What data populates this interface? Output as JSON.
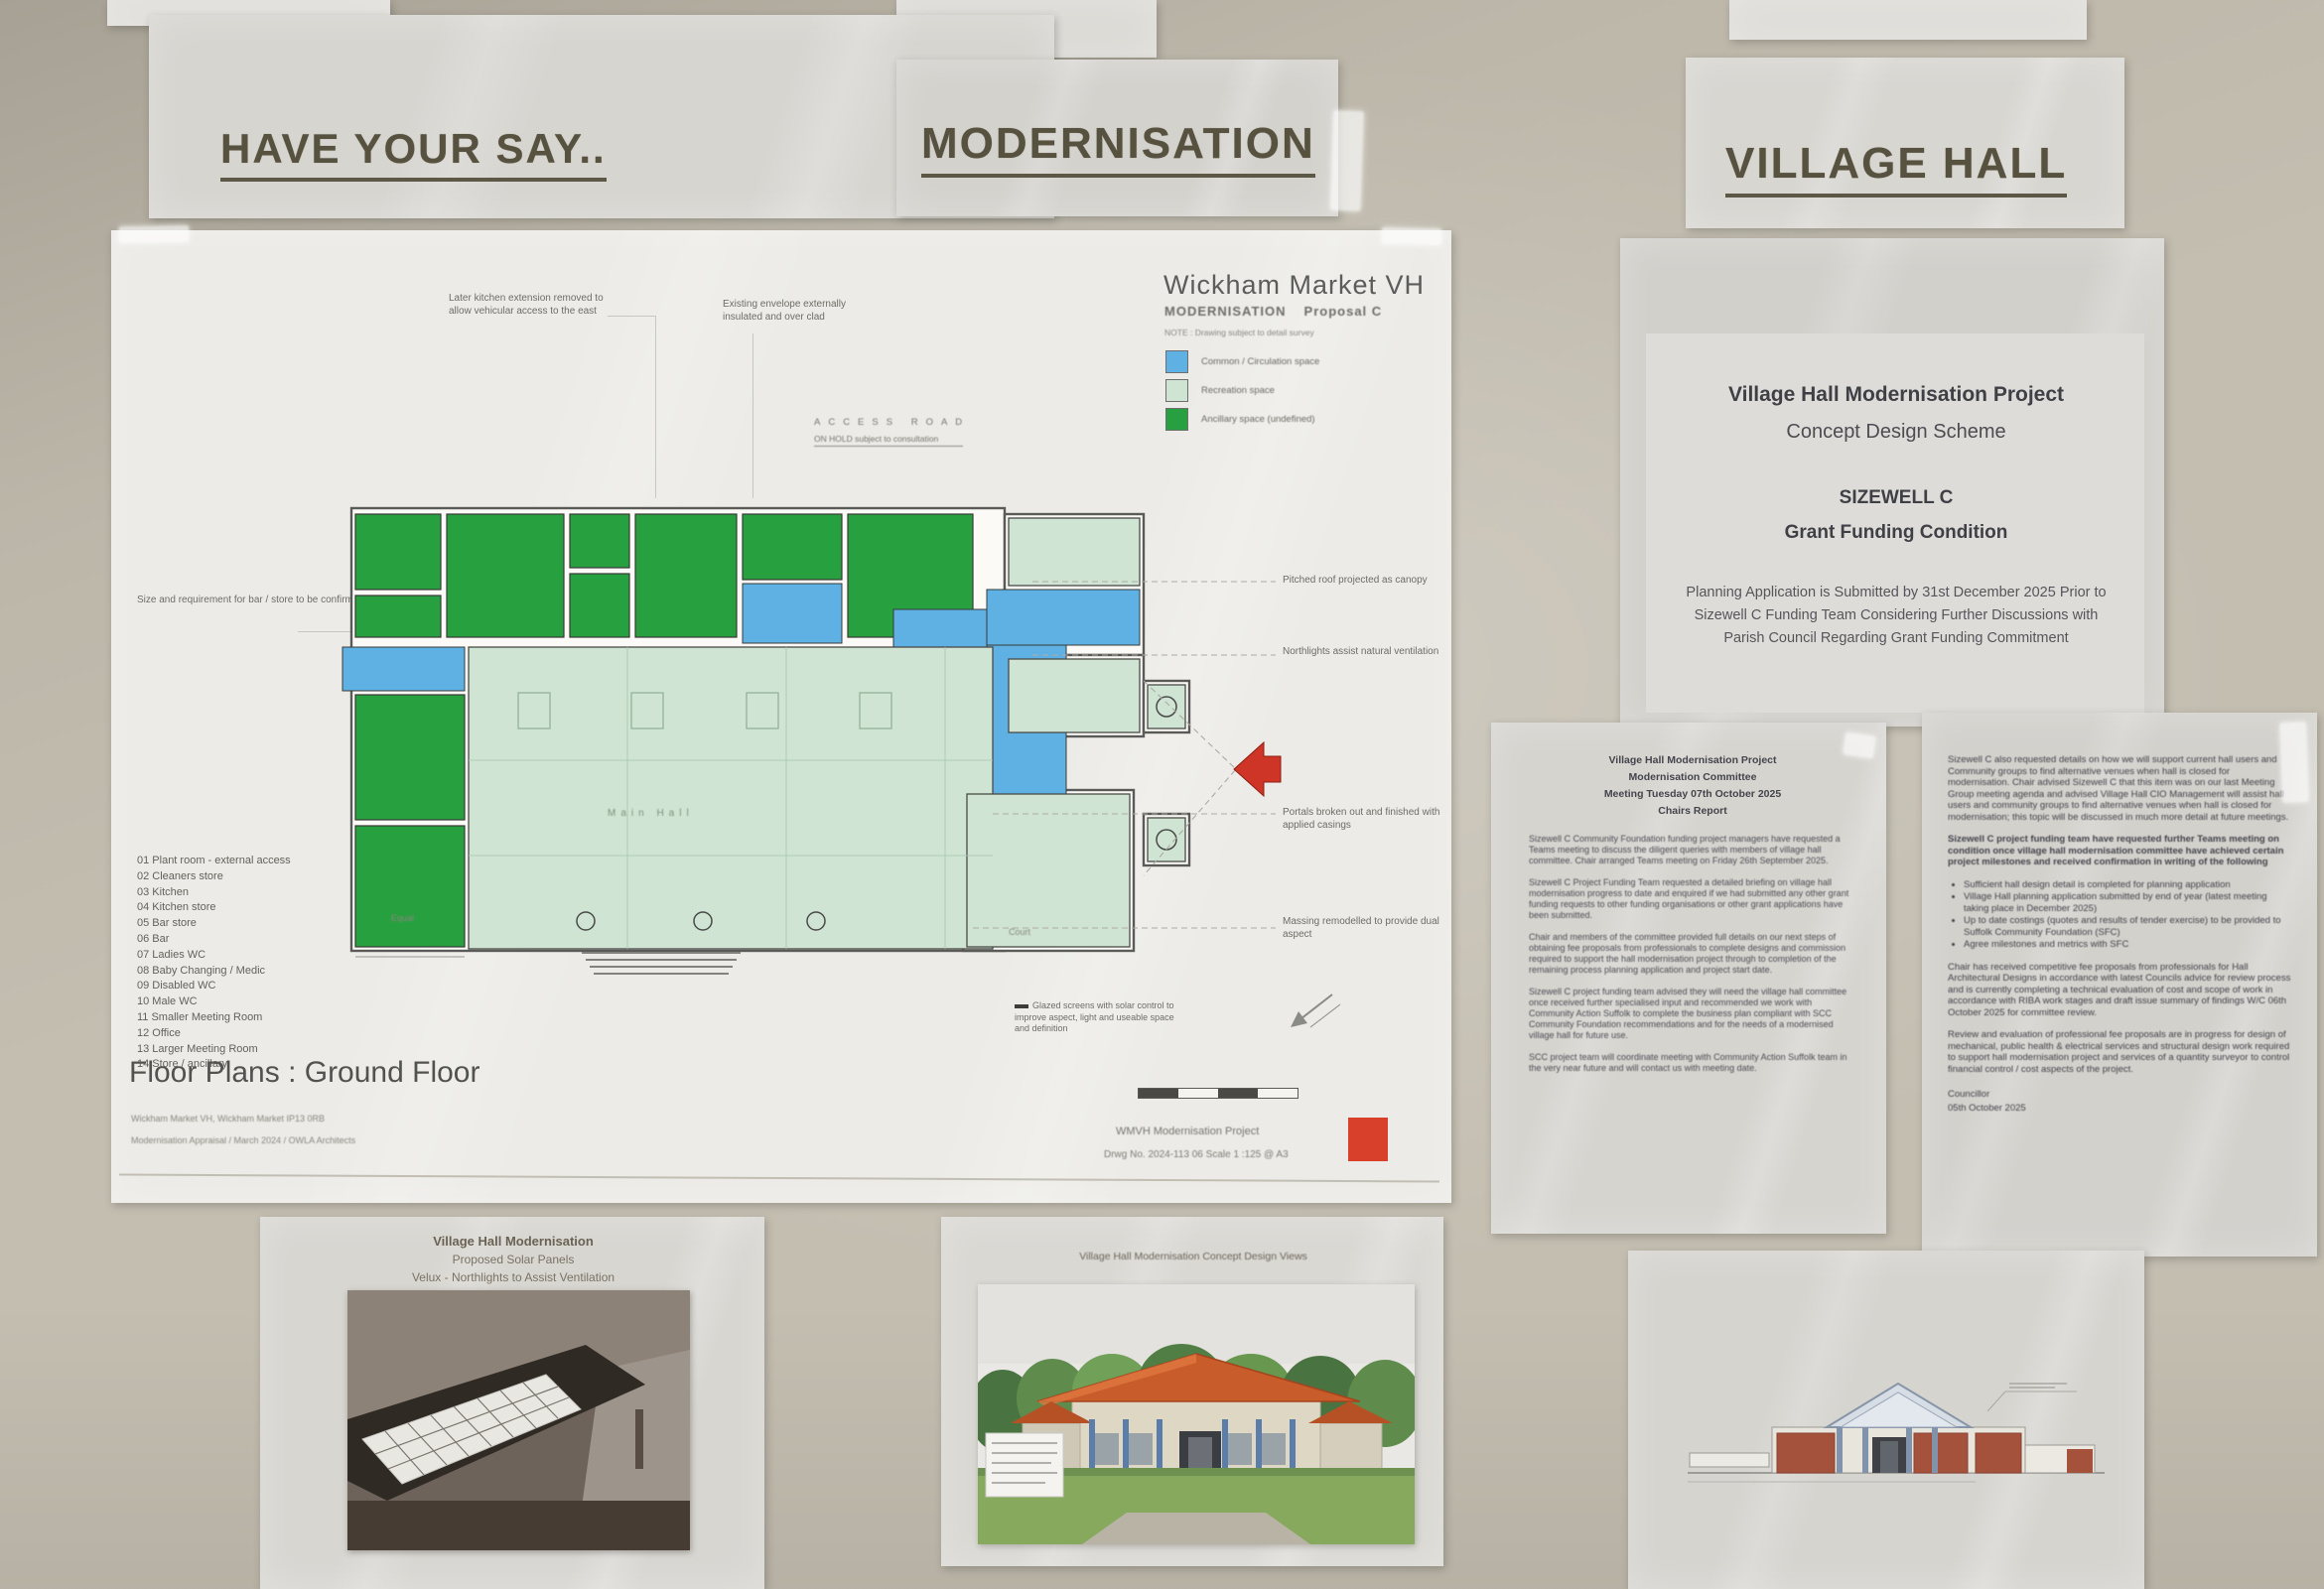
{
  "headings": {
    "left": "HAVE YOUR SAY..",
    "middle": "MODERNISATION",
    "right": "VILLAGE HALL"
  },
  "plan": {
    "title": "Wickham Market VH",
    "proposal": "MODERNISATION",
    "proposal2": "Proposal C",
    "note": "NOTE : Drawing subject to detail survey",
    "legend": [
      {
        "label": "Common / Circulation space",
        "color": "#5fb0e3"
      },
      {
        "label": "Recreation space",
        "color": "#cfe4d2"
      },
      {
        "label": "Ancillary space (undefined)",
        "color": "#27a03f"
      }
    ],
    "ann": {
      "kitchen": "Later kitchen extension removed to allow vehicular access to the east",
      "envelope": "Existing envelope externally insulated and over clad",
      "access_road": "ACCESS ROAD",
      "on_hold": "ON HOLD subject to consultation",
      "bar_store": "Size and requirement for bar / store to be confirmed",
      "canopy": "Pitched roof projected as canopy",
      "northlights": "Northlights assist natural ventilation",
      "portals": "Portals broken out and finished with applied casings",
      "massing": "Massing remodelled to provide dual aspect",
      "glazing": "Glazed screens with solar control to improve aspect, light and useable space and definition",
      "main_hall": "Main Hall",
      "equal": "Equal",
      "court": "Court"
    },
    "rooms": [
      "01 Plant room - external access",
      "02 Cleaners store",
      "03 Kitchen",
      "04 Kitchen store",
      "05 Bar store",
      "06 Bar",
      "07 Ladies WC",
      "08 Baby Changing / Medic",
      "09 Disabled WC",
      "10 Male WC",
      "11 Smaller Meeting Room",
      "12 Office",
      "13 Larger Meeting Room",
      "14 Store / ancillary"
    ],
    "drawing_title": "Floor Plans : Ground Floor",
    "footer": {
      "left1": "Wickham Market VH, Wickham Market IP13 0RB",
      "left2": "Modernisation Appraisal / March 2024 / OWLA Architects",
      "right1": "WMVH Modernisation Project",
      "right2": "Drwg No. 2024-113 06    Scale 1 :125 @ A3"
    }
  },
  "concept": {
    "line1": "Village Hall Modernisation Project",
    "line2": "Concept Design Scheme",
    "line3": "SIZEWELL C",
    "line4": "Grant Funding Condition",
    "body": "Planning Application is Submitted by 31st December 2025 Prior to Sizewell C Funding Team Considering Further Discussions with Parish Council Regarding Grant Funding Commitment"
  },
  "minutes": {
    "title1": "Village Hall Modernisation Project",
    "title2": "Modernisation Committee",
    "title3": "Meeting Tuesday 07th October 2025",
    "title4": "Chairs Report",
    "paragraphs": [
      "Sizewell C Community Foundation funding project managers have requested a Teams meeting to discuss the diligent queries with members of village hall committee. Chair arranged Teams meeting on Friday 26th September 2025.",
      "Sizewell C Project Funding Team requested a detailed briefing on village hall modernisation progress to date and enquired if we had submitted any other grant funding requests to other funding organisations or other grant applications have been submitted.",
      "Chair and members of the committee provided full details on our next steps of obtaining fee proposals from professionals to complete designs and commission required to support the hall modernisation project through to completion of the remaining process planning application and project start date.",
      "Sizewell C project funding team advised they will need the village hall committee once received further specialised input and recommended we work with Community Action Suffolk to complete the business plan compliant with SCC Community Foundation recommendations and for the needs of a modernised village hall for future use.",
      "SCC project team will coordinate meeting with Community Action Suffolk team in the very near future and will contact us with meeting date."
    ]
  },
  "milestones": {
    "p1": "Sizewell C also requested details on how we will support current hall users and Community groups to find alternative venues when hall is closed for modernisation. Chair advised Sizewell C that this item was on our last Meeting Group meeting agenda and advised Village Hall CIO Management will assist hall users and community groups to find alternative venues when hall is closed for modernisation; this topic will be discussed in much more detail at future meetings.",
    "p2": "Sizewell C project funding team have requested further Teams meeting on condition once village hall modernisation committee have achieved certain project milestones and received confirmation in writing of the following",
    "bullets": [
      "Sufficient hall design detail is completed for planning application",
      "Village Hall planning application submitted by end of year (latest meeting taking place in December 2025)",
      "Up to date costings (quotes and results of tender exercise) to be provided to Suffolk Community Foundation (SFC)",
      "Agree milestones and metrics with SFC"
    ],
    "p3": "Chair has received competitive fee proposals from professionals for Hall Architectural Designs in accordance with latest Councils advice for review process and is currently completing a technical evaluation of cost and scope of work in accordance with RIBA work stages and draft issue summary of findings W/C 06th October 2025 for committee review.",
    "p4": "Review and evaluation of professional fee proposals are in progress for design of mechanical, public health & electrical services and structural design work required to support hall modernisation project and services of a quantity surveyor to control financial control / cost aspects of the project.",
    "signoff1": "Councillor",
    "signoff2": "05th October 2025"
  },
  "bottom": {
    "solar1": "Village Hall Modernisation",
    "solar2": "Proposed Solar Panels",
    "solar3": "Velux - Northlights to Assist Ventilation",
    "render_caption": "Village Hall Modernisation Concept Design Views"
  }
}
